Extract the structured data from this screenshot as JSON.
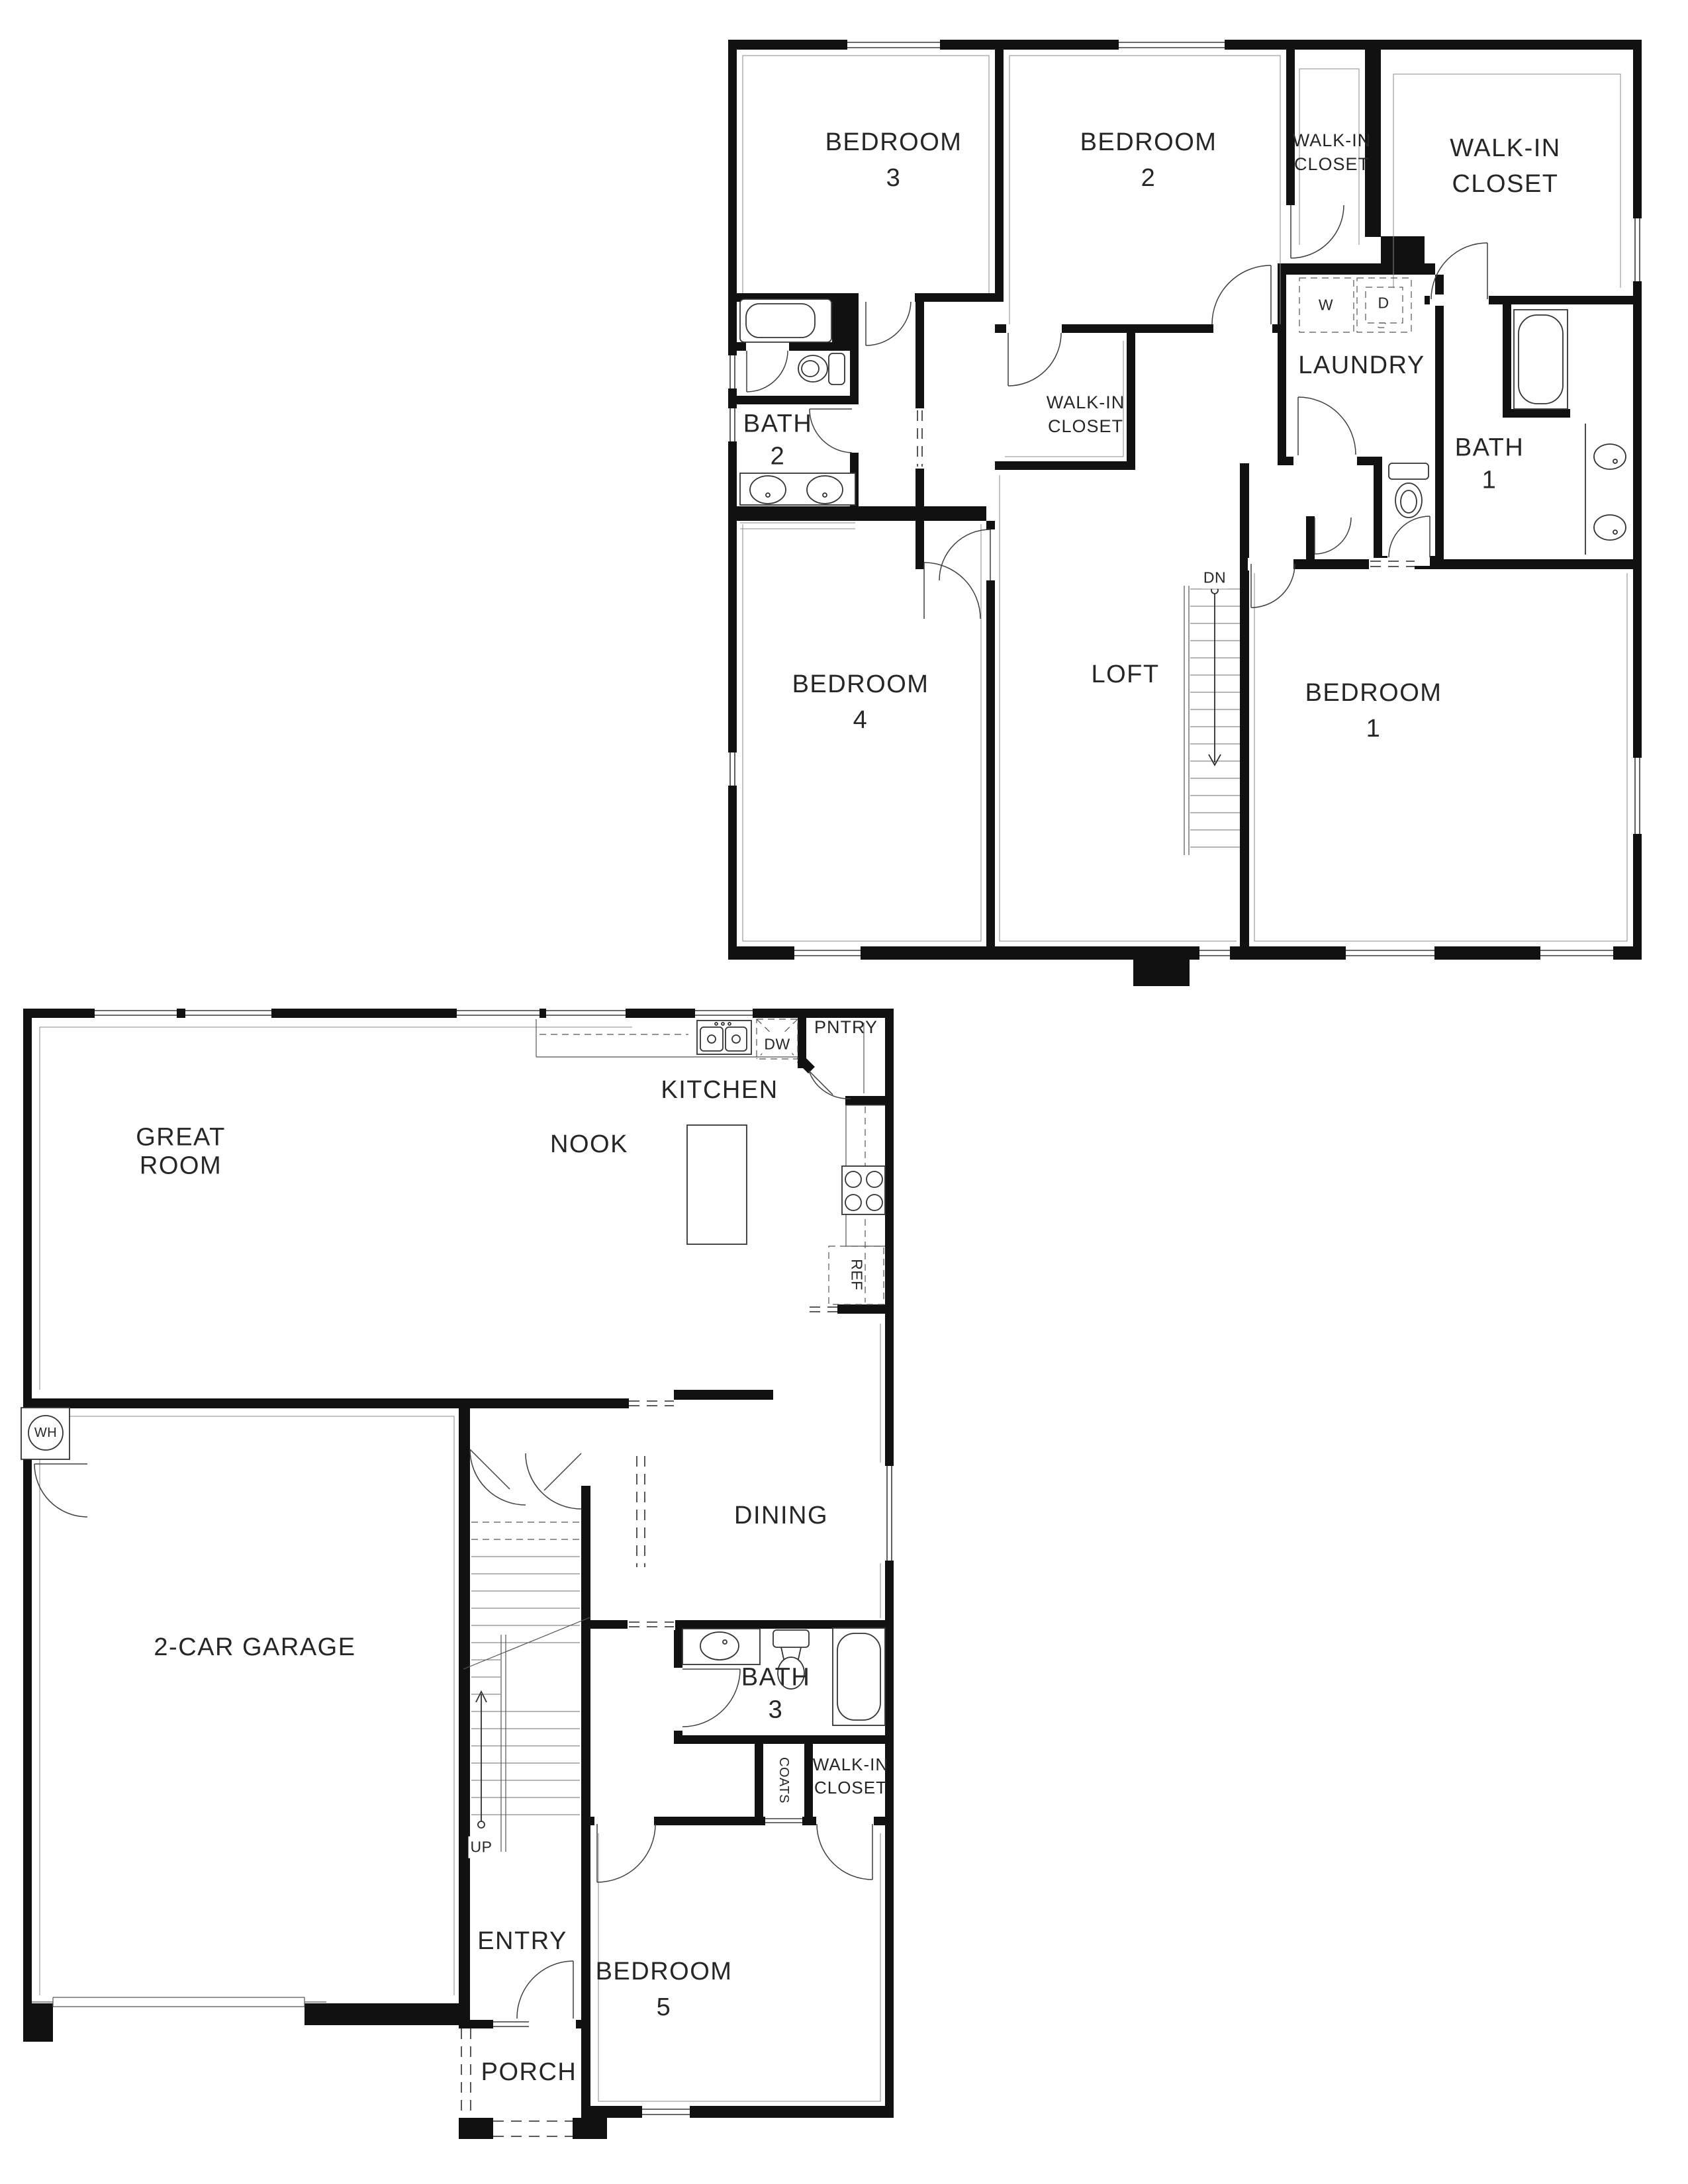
{
  "floor2": {
    "bedroom3": "BEDROOM\n3",
    "bedroom2": "BEDROOM\n2",
    "walk_in_closet_small": "WALK-IN\nCLOSET",
    "walk_in_closet_large": "WALK-IN\nCLOSET",
    "walk_in_closet_mid": "WALK-IN\nCLOSET",
    "laundry": "LAUNDRY",
    "washer": "W",
    "dryer": "D",
    "bath1": "BATH\n1",
    "bath2": "BATH\n2",
    "bedroom4": "BEDROOM\n4",
    "loft": "LOFT",
    "stairs_direction": "DN",
    "bedroom1": "BEDROOM\n1"
  },
  "floor1": {
    "great_room": "GREAT\nROOM",
    "nook": "NOOK",
    "kitchen": "KITCHEN",
    "pantry": "PNTRY",
    "dishwasher": "DW",
    "refrigerator": "REF",
    "dining": "DINING",
    "garage": "2-CAR GARAGE",
    "water_heater": "WH",
    "bath3": "BATH\n3",
    "coats": "COATS",
    "walk_in_closet": "WALK-IN\nCLOSET",
    "entry": "ENTRY",
    "stairs_direction": "UP",
    "bedroom5": "BEDROOM\n5",
    "porch": "PORCH"
  },
  "colors": {
    "wall": "#111111",
    "line": "#3f3f3f",
    "label": "#262626",
    "background": "#ffffff"
  }
}
